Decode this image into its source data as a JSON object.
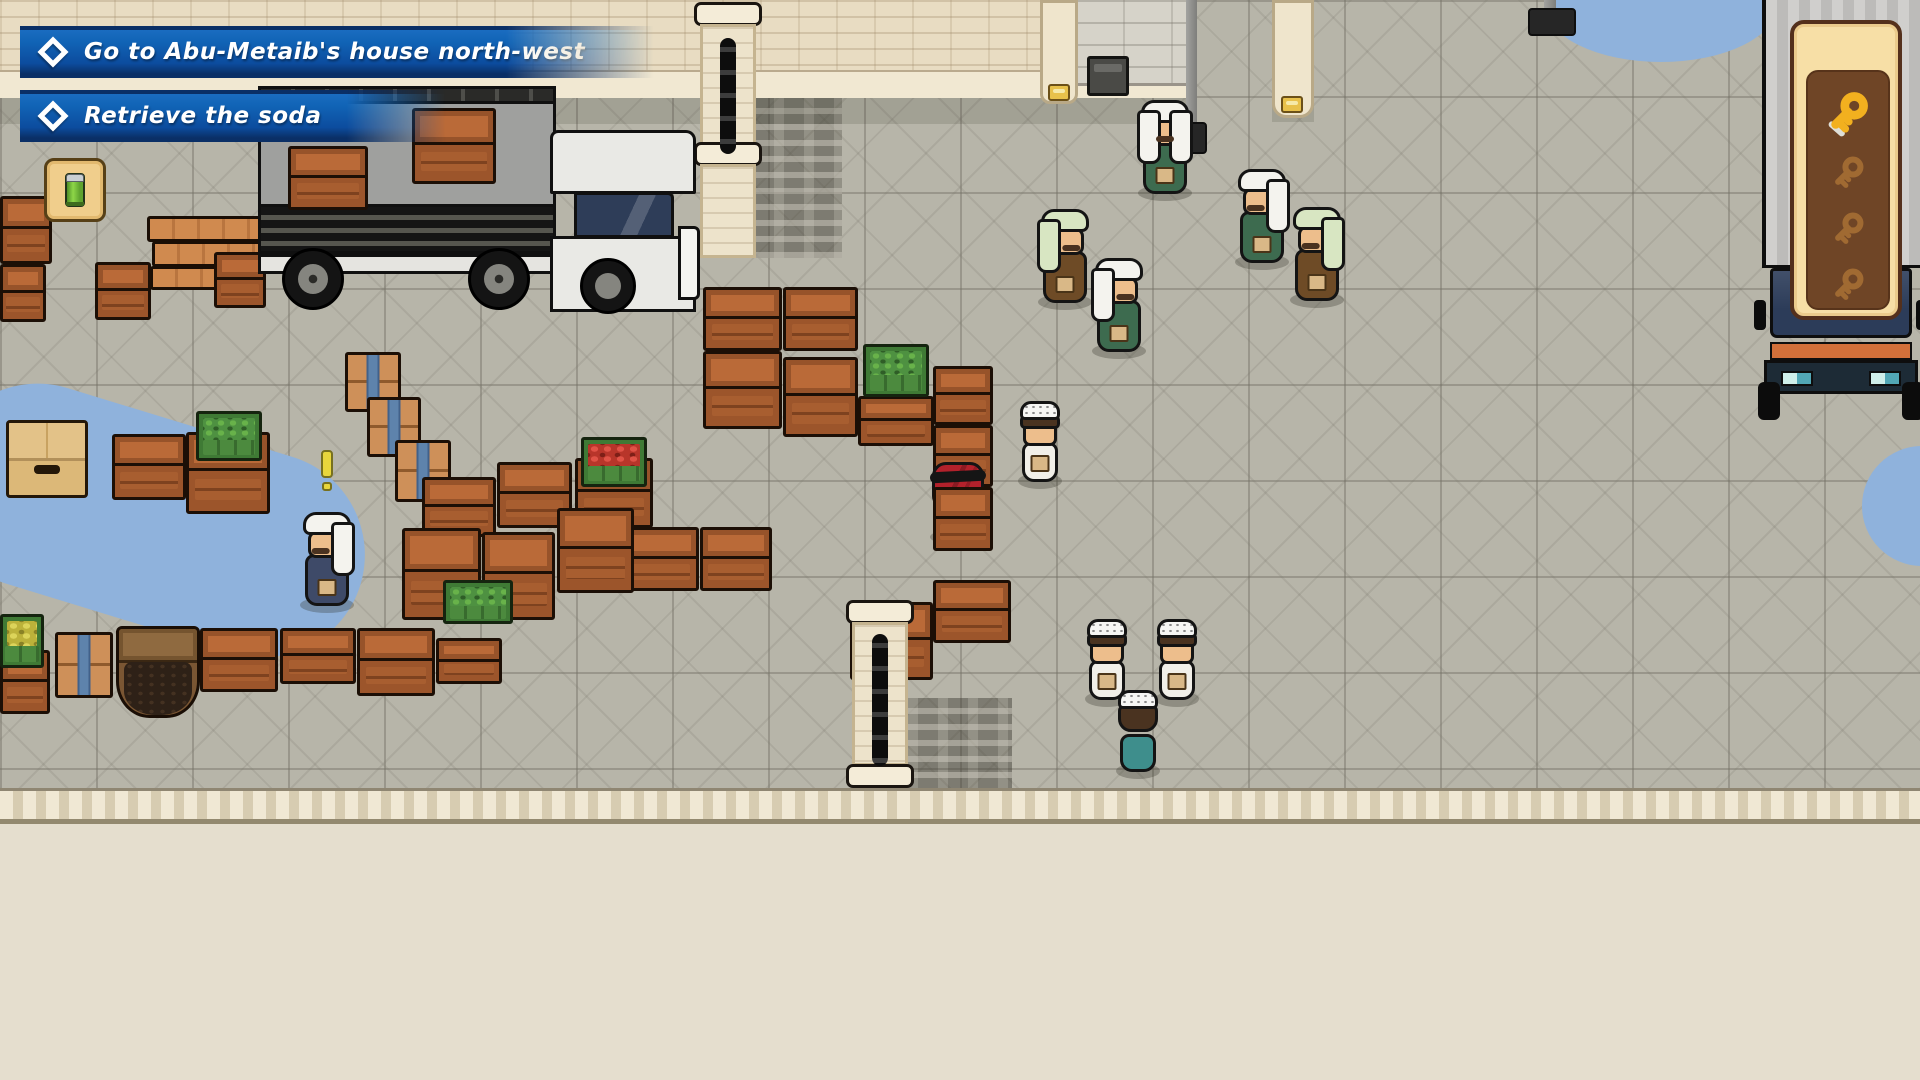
{
  "hud": {
    "objectives": [
      {
        "label": "Go to Abu-Metaib's house north-west"
      },
      {
        "label": "Retrieve the soda"
      }
    ],
    "soda_slot": {
      "item": "soda-can"
    }
  },
  "key_panel": {
    "slots": [
      {
        "state": "found"
      },
      {
        "state": "missing"
      },
      {
        "state": "missing"
      },
      {
        "state": "missing"
      }
    ],
    "colors": {
      "panel": "#F7DFA6",
      "inner": "#6F4526",
      "key_gold": "#F2B01F",
      "key_outline": "#3A2408",
      "key_silhouette": "#A06A32"
    }
  },
  "scene": {
    "colors": {
      "ground": "#B7B5A9",
      "wall_beige": "#E8DCC2",
      "wall_gray": "#D6D3C9",
      "banner_blue": "#1164B6",
      "banner_edge": "#0A2F66",
      "water": "#8FB2DC",
      "crate_brown": "#9C552B",
      "crate_lid": "#BA6A38",
      "robe_green": "#3D6B4F",
      "robe_brown": "#6E4B26",
      "robe_white": "#F1EFE8",
      "robe_navy": "#3E4A68",
      "shirt_teal": "#3E8E8C",
      "keffiyeh_white": "#F4F3EE",
      "keffiyeh_green": "#D8E6C2",
      "player_red": "#B3212B",
      "skin": "#EDBE8C"
    },
    "objects": [
      {
        "type": "crate",
        "x": 0,
        "y": 196,
        "w": 52,
        "h": 68
      },
      {
        "type": "crate",
        "x": 0,
        "y": 264,
        "w": 46,
        "h": 58
      },
      {
        "type": "lumber",
        "x": 147,
        "y": 216,
        "w": 138,
        "h": 26
      },
      {
        "type": "lumber",
        "x": 152,
        "y": 241,
        "w": 132,
        "h": 26
      },
      {
        "type": "crate",
        "x": 95,
        "y": 262,
        "w": 56,
        "h": 58
      },
      {
        "type": "lumber",
        "x": 150,
        "y": 266,
        "w": 116,
        "h": 24
      },
      {
        "type": "crate",
        "x": 214,
        "y": 252,
        "w": 52,
        "h": 56
      },
      {
        "type": "crate",
        "x": 288,
        "y": 146,
        "w": 80,
        "h": 64,
        "dz": 260
      },
      {
        "type": "crate",
        "x": 412,
        "y": 108,
        "w": 84,
        "h": 76,
        "dz": 260
      },
      {
        "type": "cardboard",
        "x": 6,
        "y": 420,
        "w": 82,
        "h": 78
      },
      {
        "type": "crate",
        "x": 112,
        "y": 434,
        "w": 74,
        "h": 66
      },
      {
        "type": "veg",
        "variant": "greens",
        "x": 196,
        "y": 411,
        "w": 66,
        "h": 50,
        "dz": 110
      },
      {
        "type": "crate",
        "x": 186,
        "y": 432,
        "w": 84,
        "h": 82
      },
      {
        "type": "veg",
        "variant": "lemon",
        "x": 0,
        "y": 614,
        "w": 44,
        "h": 54,
        "dz": 60
      },
      {
        "type": "crate",
        "x": 0,
        "y": 650,
        "w": 50,
        "h": 64
      },
      {
        "type": "strapcrate",
        "x": 55,
        "y": 632,
        "w": 58,
        "h": 66
      },
      {
        "type": "barrel",
        "x": 116,
        "y": 626,
        "w": 84,
        "h": 92
      },
      {
        "type": "crate",
        "x": 200,
        "y": 628,
        "w": 78,
        "h": 64
      },
      {
        "type": "crate",
        "x": 280,
        "y": 628,
        "w": 76,
        "h": 56
      },
      {
        "type": "crate",
        "x": 357,
        "y": 628,
        "w": 78,
        "h": 68
      },
      {
        "type": "crate",
        "x": 436,
        "y": 638,
        "w": 66,
        "h": 46
      },
      {
        "type": "strapcrate",
        "x": 345,
        "y": 352,
        "w": 56,
        "h": 60
      },
      {
        "type": "strapcrate",
        "x": 367,
        "y": 397,
        "w": 54,
        "h": 60
      },
      {
        "type": "strapcrate",
        "x": 395,
        "y": 440,
        "w": 56,
        "h": 62
      },
      {
        "type": "crate",
        "x": 422,
        "y": 477,
        "w": 74,
        "h": 60
      },
      {
        "type": "crate",
        "x": 497,
        "y": 462,
        "w": 75,
        "h": 66
      },
      {
        "type": "veg",
        "variant": "tomato",
        "x": 581,
        "y": 437,
        "w": 66,
        "h": 50,
        "dz": 80
      },
      {
        "type": "crate",
        "x": 575,
        "y": 458,
        "w": 78,
        "h": 70
      },
      {
        "type": "crate",
        "x": 402,
        "y": 528,
        "w": 79,
        "h": 92
      },
      {
        "type": "crate",
        "x": 482,
        "y": 532,
        "w": 73,
        "h": 88
      },
      {
        "type": "veg",
        "variant": "greens",
        "x": 443,
        "y": 580,
        "w": 70,
        "h": 44,
        "dz": 80
      },
      {
        "type": "crate",
        "x": 557,
        "y": 508,
        "w": 77,
        "h": 85
      },
      {
        "type": "crate",
        "x": 622,
        "y": 527,
        "w": 77,
        "h": 64
      },
      {
        "type": "crate",
        "x": 700,
        "y": 527,
        "w": 72,
        "h": 64
      },
      {
        "type": "crate",
        "x": 703,
        "y": 287,
        "w": 79,
        "h": 64
      },
      {
        "type": "crate",
        "x": 783,
        "y": 287,
        "w": 75,
        "h": 64
      },
      {
        "type": "crate",
        "x": 703,
        "y": 351,
        "w": 79,
        "h": 78
      },
      {
        "type": "crate",
        "x": 783,
        "y": 357,
        "w": 75,
        "h": 80
      },
      {
        "type": "veg",
        "variant": "greens",
        "x": 863,
        "y": 344,
        "w": 66,
        "h": 53,
        "dz": 60
      },
      {
        "type": "crate",
        "x": 858,
        "y": 396,
        "w": 76,
        "h": 50
      },
      {
        "type": "crate",
        "x": 933,
        "y": 366,
        "w": 60,
        "h": 59
      },
      {
        "type": "crate",
        "x": 933,
        "y": 425,
        "w": 60,
        "h": 62
      },
      {
        "type": "crate",
        "x": 933,
        "y": 487,
        "w": 60,
        "h": 64
      },
      {
        "type": "crate",
        "x": 850,
        "y": 602,
        "w": 83,
        "h": 78
      },
      {
        "type": "crate",
        "x": 933,
        "y": 580,
        "w": 78,
        "h": 63
      }
    ],
    "characters": [
      {
        "name": "npc-elder-white-green",
        "type": "elder",
        "facing": "down",
        "robe": "robe_green",
        "keffiyeh": "keffiyeh_white",
        "x": 1136,
        "y": 94
      },
      {
        "name": "npc-elder-brown-left",
        "type": "elder",
        "facing": "right",
        "robe": "robe_brown",
        "keffiyeh": "keffiyeh_green",
        "x": 1036,
        "y": 203
      },
      {
        "name": "npc-elder-green-left",
        "type": "elder",
        "facing": "right",
        "robe": "robe_green",
        "keffiyeh": "keffiyeh_white",
        "x": 1090,
        "y": 252
      },
      {
        "name": "npc-elder-green-right",
        "type": "elder",
        "facing": "left",
        "robe": "robe_green",
        "keffiyeh": "keffiyeh_white",
        "x": 1233,
        "y": 163
      },
      {
        "name": "npc-elder-brown-right",
        "type": "elder",
        "facing": "left",
        "robe": "robe_brown",
        "keffiyeh": "keffiyeh_green",
        "x": 1288,
        "y": 201
      },
      {
        "name": "npc-boy-near-player",
        "type": "boy",
        "facing": "down",
        "x": 1016,
        "y": 398
      },
      {
        "name": "player-character",
        "type": "player",
        "facing": "down",
        "x": 928,
        "y": 460
      },
      {
        "name": "npc-boy-pair-left",
        "type": "boy",
        "facing": "right",
        "x": 1083,
        "y": 616
      },
      {
        "name": "npc-boy-pair-right",
        "type": "boy",
        "facing": "left",
        "x": 1153,
        "y": 616
      },
      {
        "name": "npc-boy-teal-back",
        "type": "boy-back",
        "facing": "up",
        "x": 1114,
        "y": 688
      },
      {
        "name": "npc-elder-navy-quest",
        "type": "elder",
        "facing": "left",
        "robe": "robe_navy",
        "keffiyeh": "keffiyeh_white",
        "x": 298,
        "y": 506,
        "marker": "exclamation"
      }
    ]
  }
}
